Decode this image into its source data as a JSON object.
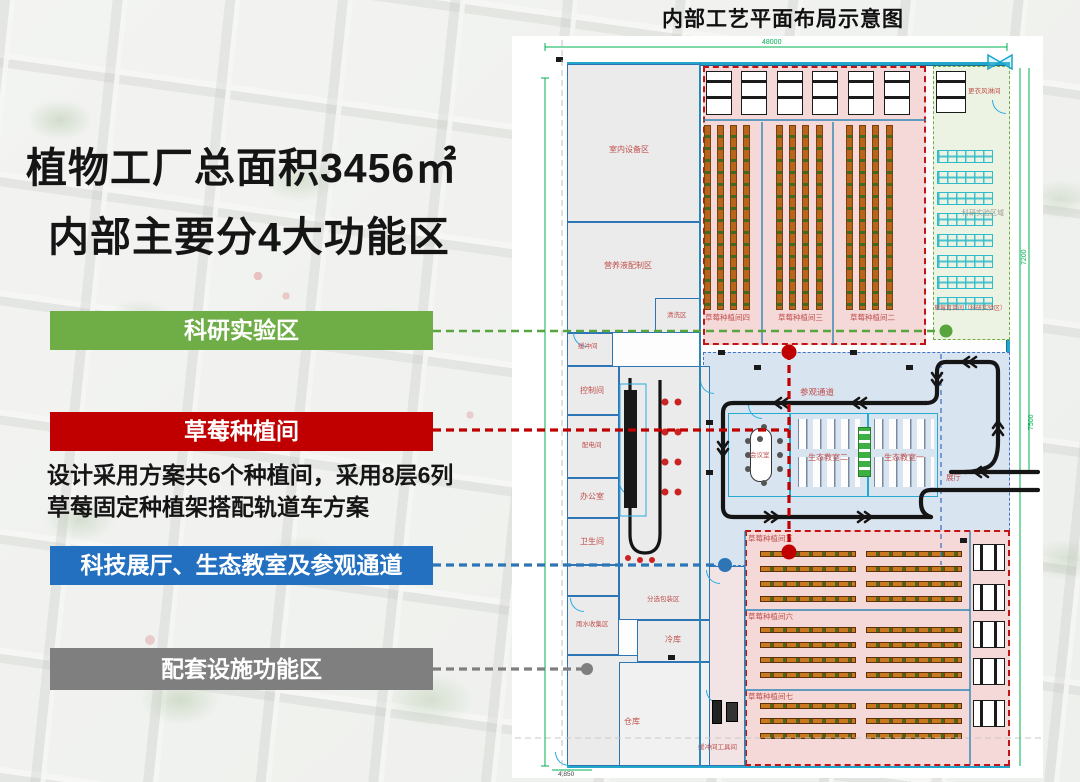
{
  "left_panel": {
    "title_line1": "植物工厂总面积3456㎡",
    "title_line2": "内部主要分4大功能区",
    "banners": [
      {
        "id": "research",
        "label": "科研实验区",
        "color": "#6FAE46"
      },
      {
        "id": "strawberry",
        "label": "草莓种植间",
        "color": "#C00000"
      },
      {
        "id": "exhibit",
        "label": "科技展厅、生态教室及参观通道",
        "color": "#2470C0"
      },
      {
        "id": "support",
        "label": "配套设施功能区",
        "color": "#7F7F7F"
      }
    ],
    "description_line1": "设计采用方案共6个种植间，采用8层6列",
    "description_line2": "草莓固定种植架搭配轨道车方案"
  },
  "plan": {
    "title": "内部工艺平面布局示意图",
    "labels": {
      "indoor_equipment": "室内设备区",
      "nutrient": "营养液配制区",
      "washing": "清洗区",
      "buffer": "缓冲间",
      "control": "控制间",
      "power": "配电间",
      "office": "办公室",
      "toilet": "卫生间",
      "rainwater": "雨水收集区",
      "warehouse": "仓库",
      "sorting": "分选包装区",
      "cold_storage": "冷库",
      "room4": "草莓种植间四",
      "room3": "草莓种植间三",
      "room2": "草莓种植间二",
      "room5": "草莓种植间五",
      "room6": "草莓种植间六",
      "room7": "草莓种植间七",
      "changing": "更衣风淋间",
      "research_area": "科研实验区域",
      "nursery": "草莓育苗间（科研实验区）",
      "tour_corridor": "参观通道",
      "meeting": "会议室",
      "eco2": "生态教室二",
      "eco1": "生态教室一",
      "hall": "展厅",
      "tool": "缓冲间工具间"
    },
    "dimensions": {
      "top": "48000",
      "right_upper": "7200",
      "right_lower": "7500",
      "bottom": "4,850"
    }
  },
  "colors": {
    "accent_green": "#6FAE46",
    "accent_red": "#C00000",
    "accent_blue": "#2470C0",
    "accent_gray": "#7F7F7F",
    "zone_pink": "#F5D8D8",
    "zone_blue": "#D9E4F1",
    "zone_green": "#EDF3E2",
    "wall_blue": "#2E75B6",
    "wall_cyan": "#24A6CC",
    "dimension_green": "#00B050",
    "rack_orange": "#B8641B",
    "rack_cyan": "#2FBBCB"
  }
}
